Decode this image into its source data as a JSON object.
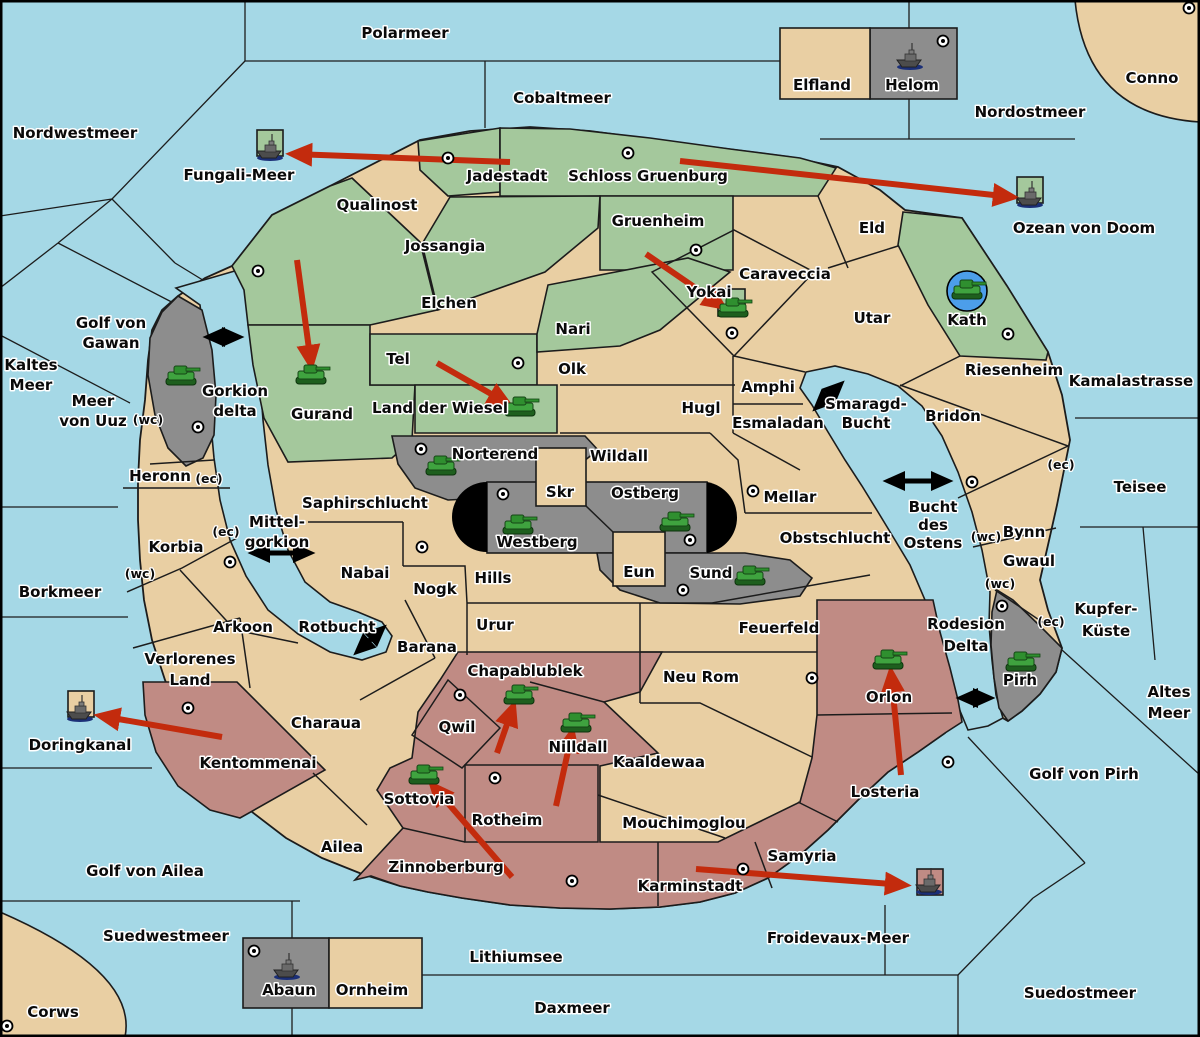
{
  "map": {
    "title": "Fantasy conquest map",
    "colors": {
      "sea": "#A5D8E6",
      "land": "#E9CFA3",
      "green": "#A4C89C",
      "gray": "#8D8D8D",
      "maroon": "#C08B84",
      "black": "#000000",
      "arrow_red": "#C32B0D",
      "kath_circle_blue": "#4C9EEA",
      "border": "#1C1C1C"
    },
    "labels": [
      {
        "t": "Polarmeer",
        "x": 405,
        "y": 38,
        "k": "sea"
      },
      {
        "t": "Cobaltmeer",
        "x": 562,
        "y": 103,
        "k": "sea"
      },
      {
        "t": "Nordostmeer",
        "x": 1030,
        "y": 117,
        "k": "sea"
      },
      {
        "t": "Nordwestmeer",
        "x": 75,
        "y": 138,
        "k": "sea"
      },
      {
        "t": "Conno",
        "x": 1152,
        "y": 83,
        "k": "land"
      },
      {
        "t": "Fungali-Meer",
        "x": 239,
        "y": 180,
        "k": "sea"
      },
      {
        "t": "Ozean von Doom",
        "x": 1084,
        "y": 233,
        "k": "sea"
      },
      {
        "t": "Kaltes",
        "x": 31,
        "y": 370,
        "k": "sea"
      },
      {
        "t": "Meer",
        "x": 31,
        "y": 390,
        "k": "sea"
      },
      {
        "t": "Golf von",
        "x": 111,
        "y": 328,
        "k": "sea"
      },
      {
        "t": "Gawan",
        "x": 111,
        "y": 348,
        "k": "sea"
      },
      {
        "t": "Meer",
        "x": 93,
        "y": 406,
        "k": "sea"
      },
      {
        "t": "von Uuz",
        "x": 93,
        "y": 426,
        "k": "sea"
      },
      {
        "t": "Gorkion",
        "x": 235,
        "y": 396,
        "k": "sea"
      },
      {
        "t": "delta",
        "x": 235,
        "y": 416,
        "k": "sea"
      },
      {
        "t": "Kamalastrasse",
        "x": 1131,
        "y": 386,
        "k": "sea"
      },
      {
        "t": "Teisee",
        "x": 1140,
        "y": 492,
        "k": "sea"
      },
      {
        "t": "Smaragd-",
        "x": 866,
        "y": 409,
        "k": "sea"
      },
      {
        "t": "Bucht",
        "x": 866,
        "y": 428,
        "k": "sea"
      },
      {
        "t": "Bucht",
        "x": 933,
        "y": 512,
        "k": "sea"
      },
      {
        "t": "des",
        "x": 933,
        "y": 530,
        "k": "sea"
      },
      {
        "t": "Ostens",
        "x": 933,
        "y": 548,
        "k": "sea"
      },
      {
        "t": "Mittel-",
        "x": 277,
        "y": 527,
        "k": "sea"
      },
      {
        "t": "gorkion",
        "x": 277,
        "y": 547,
        "k": "sea"
      },
      {
        "t": "Borkmeer",
        "x": 60,
        "y": 597,
        "k": "sea"
      },
      {
        "t": "Rotbucht",
        "x": 337,
        "y": 632,
        "k": "sea"
      },
      {
        "t": "Kupfer-",
        "x": 1106,
        "y": 614,
        "k": "sea"
      },
      {
        "t": "Küste",
        "x": 1106,
        "y": 636,
        "k": "sea"
      },
      {
        "t": "Altes",
        "x": 1169,
        "y": 697,
        "k": "sea"
      },
      {
        "t": "Meer",
        "x": 1169,
        "y": 718,
        "k": "sea"
      },
      {
        "t": "Golf von Pirh",
        "x": 1084,
        "y": 779,
        "k": "sea"
      },
      {
        "t": "Rodesion",
        "x": 966,
        "y": 629,
        "k": "sea"
      },
      {
        "t": "Delta",
        "x": 966,
        "y": 651,
        "k": "sea"
      },
      {
        "t": "Doringkanal",
        "x": 80,
        "y": 750,
        "k": "sea"
      },
      {
        "t": "Golf von Ailea",
        "x": 145,
        "y": 876,
        "k": "sea"
      },
      {
        "t": "Suedwestmeer",
        "x": 166,
        "y": 941,
        "k": "sea"
      },
      {
        "t": "Corws",
        "x": 53,
        "y": 1017,
        "k": "land"
      },
      {
        "t": "Lithiumsee",
        "x": 516,
        "y": 962,
        "k": "sea"
      },
      {
        "t": "Daxmeer",
        "x": 572,
        "y": 1013,
        "k": "sea"
      },
      {
        "t": "Froidevaux-Meer",
        "x": 838,
        "y": 943,
        "k": "sea"
      },
      {
        "t": "Suedostmeer",
        "x": 1080,
        "y": 998,
        "k": "sea"
      },
      {
        "t": "Elfland",
        "x": 822,
        "y": 90,
        "k": "land"
      },
      {
        "t": "Helom",
        "x": 912,
        "y": 90,
        "k": "land"
      },
      {
        "t": "Jadestadt",
        "x": 507,
        "y": 181,
        "k": "land"
      },
      {
        "t": "Schloss Gruenburg",
        "x": 648,
        "y": 181,
        "k": "land"
      },
      {
        "t": "Qualinost",
        "x": 377,
        "y": 210,
        "k": "land"
      },
      {
        "t": "Jossangia",
        "x": 445,
        "y": 251,
        "k": "land"
      },
      {
        "t": "Gruenheim",
        "x": 658,
        "y": 226,
        "k": "land"
      },
      {
        "t": "Caraveccia",
        "x": 785,
        "y": 279,
        "k": "land"
      },
      {
        "t": "Eld",
        "x": 872,
        "y": 233,
        "k": "land"
      },
      {
        "t": "Elchen",
        "x": 449,
        "y": 308,
        "k": "land"
      },
      {
        "t": "Nari",
        "x": 573,
        "y": 334,
        "k": "land"
      },
      {
        "t": "Yokai",
        "x": 709,
        "y": 297,
        "k": "land"
      },
      {
        "t": "Utar",
        "x": 872,
        "y": 323,
        "k": "land"
      },
      {
        "t": "Kath",
        "x": 967,
        "y": 325,
        "k": "land"
      },
      {
        "t": "Tel",
        "x": 398,
        "y": 364,
        "k": "land"
      },
      {
        "t": "Land der Wiesel",
        "x": 440,
        "y": 413,
        "k": "land"
      },
      {
        "t": "Olk",
        "x": 572,
        "y": 374,
        "k": "land"
      },
      {
        "t": "Gurand",
        "x": 322,
        "y": 419,
        "k": "land"
      },
      {
        "t": "Hugl",
        "x": 701,
        "y": 413,
        "k": "land"
      },
      {
        "t": "Amphi",
        "x": 768,
        "y": 392,
        "k": "land"
      },
      {
        "t": "Esmaladan",
        "x": 778,
        "y": 428,
        "k": "land"
      },
      {
        "t": "Riesenheim",
        "x": 1014,
        "y": 375,
        "k": "land"
      },
      {
        "t": "Bridon",
        "x": 953,
        "y": 421,
        "k": "land"
      },
      {
        "t": "Norterend",
        "x": 495,
        "y": 459,
        "k": "land"
      },
      {
        "t": "Wildall",
        "x": 619,
        "y": 461,
        "k": "land"
      },
      {
        "t": "Skr",
        "x": 560,
        "y": 497,
        "k": "land"
      },
      {
        "t": "Ostberg",
        "x": 645,
        "y": 498,
        "k": "land"
      },
      {
        "t": "Mellar",
        "x": 790,
        "y": 502,
        "k": "land"
      },
      {
        "t": "Westberg",
        "x": 537,
        "y": 547,
        "k": "land"
      },
      {
        "t": "Obstschlucht",
        "x": 835,
        "y": 543,
        "k": "land"
      },
      {
        "t": "Saphirschlucht",
        "x": 365,
        "y": 508,
        "k": "land"
      },
      {
        "t": "Heronn",
        "x": 160,
        "y": 481,
        "k": "land"
      },
      {
        "t": "Korbia",
        "x": 176,
        "y": 552,
        "k": "land"
      },
      {
        "t": "Nabai",
        "x": 365,
        "y": 578,
        "k": "land"
      },
      {
        "t": "Eun",
        "x": 639,
        "y": 577,
        "k": "land"
      },
      {
        "t": "Sund",
        "x": 711,
        "y": 578,
        "k": "land"
      },
      {
        "t": "Hills",
        "x": 493,
        "y": 583,
        "k": "land"
      },
      {
        "t": "Nogk",
        "x": 435,
        "y": 594,
        "k": "land"
      },
      {
        "t": "Urur",
        "x": 495,
        "y": 630,
        "k": "land"
      },
      {
        "t": "Feuerfeld",
        "x": 779,
        "y": 633,
        "k": "land"
      },
      {
        "t": "Barana",
        "x": 427,
        "y": 652,
        "k": "land"
      },
      {
        "t": "Neu Rom",
        "x": 701,
        "y": 682,
        "k": "land"
      },
      {
        "t": "Arkoon",
        "x": 243,
        "y": 632,
        "k": "land"
      },
      {
        "t": "Chapablublek",
        "x": 525,
        "y": 676,
        "k": "land"
      },
      {
        "t": "Kaaldewaa",
        "x": 659,
        "y": 767,
        "k": "land"
      },
      {
        "t": "Qwil",
        "x": 457,
        "y": 732,
        "k": "land"
      },
      {
        "t": "Nilldall",
        "x": 578,
        "y": 752,
        "k": "land"
      },
      {
        "t": "Mouchimoglou",
        "x": 684,
        "y": 828,
        "k": "land"
      },
      {
        "t": "Sottovia",
        "x": 419,
        "y": 804,
        "k": "land"
      },
      {
        "t": "Rotheim",
        "x": 507,
        "y": 825,
        "k": "land"
      },
      {
        "t": "Kentommenai",
        "x": 258,
        "y": 768,
        "k": "land"
      },
      {
        "t": "Charaua",
        "x": 326,
        "y": 728,
        "k": "land"
      },
      {
        "t": "Ailea",
        "x": 342,
        "y": 852,
        "k": "land"
      },
      {
        "t": "Zinnoberburg",
        "x": 446,
        "y": 872,
        "k": "land"
      },
      {
        "t": "Karminstadt",
        "x": 690,
        "y": 891,
        "k": "land"
      },
      {
        "t": "Samyria",
        "x": 802,
        "y": 861,
        "k": "land"
      },
      {
        "t": "Losteria",
        "x": 885,
        "y": 797,
        "k": "land"
      },
      {
        "t": "Orlon",
        "x": 889,
        "y": 702,
        "k": "land"
      },
      {
        "t": "Pirh",
        "x": 1020,
        "y": 685,
        "k": "land"
      },
      {
        "t": "Bynn",
        "x": 1024,
        "y": 537,
        "k": "land"
      },
      {
        "t": "Gwaul",
        "x": 1029,
        "y": 566,
        "k": "land"
      },
      {
        "t": "Verlorenes",
        "x": 190,
        "y": 664,
        "k": "land"
      },
      {
        "t": "Land",
        "x": 190,
        "y": 685,
        "k": "land"
      },
      {
        "t": "Abaun",
        "x": 289,
        "y": 995,
        "k": "land"
      },
      {
        "t": "Ornheim",
        "x": 372,
        "y": 995,
        "k": "land"
      },
      {
        "t": "(wc)",
        "x": 148,
        "y": 424,
        "k": "small"
      },
      {
        "t": "(wc)",
        "x": 140,
        "y": 578,
        "k": "small"
      },
      {
        "t": "(wc)",
        "x": 986,
        "y": 541,
        "k": "small"
      },
      {
        "t": "(wc)",
        "x": 1000,
        "y": 588,
        "k": "small"
      },
      {
        "t": "(ec)",
        "x": 209,
        "y": 483,
        "k": "small"
      },
      {
        "t": "(ec)",
        "x": 226,
        "y": 536,
        "k": "small"
      },
      {
        "t": "(ec)",
        "x": 1061,
        "y": 469,
        "k": "small"
      },
      {
        "t": "(ec)",
        "x": 1051,
        "y": 626,
        "k": "small"
      }
    ],
    "markers": [
      [
        448,
        158
      ],
      [
        628,
        153
      ],
      [
        943,
        41
      ],
      [
        1189,
        8
      ],
      [
        258,
        271
      ],
      [
        696,
        250
      ],
      [
        732,
        333
      ],
      [
        1008,
        334
      ],
      [
        518,
        363
      ],
      [
        198,
        427
      ],
      [
        230,
        562
      ],
      [
        421,
        449
      ],
      [
        503,
        494
      ],
      [
        690,
        540
      ],
      [
        683,
        590
      ],
      [
        753,
        491
      ],
      [
        422,
        547
      ],
      [
        460,
        695
      ],
      [
        495,
        778
      ],
      [
        572,
        881
      ],
      [
        743,
        869
      ],
      [
        188,
        708
      ],
      [
        948,
        762
      ],
      [
        812,
        678
      ],
      [
        972,
        482
      ],
      [
        1002,
        606
      ],
      [
        254,
        951
      ],
      [
        7,
        1026
      ]
    ],
    "units": [
      {
        "k": "tank",
        "x": 181,
        "y": 377
      },
      {
        "k": "tank",
        "x": 311,
        "y": 376
      },
      {
        "k": "tank",
        "x": 520,
        "y": 408
      },
      {
        "k": "tank",
        "x": 733,
        "y": 309
      },
      {
        "k": "tank",
        "x": 967,
        "y": 291,
        "circled": true
      },
      {
        "k": "tank",
        "x": 441,
        "y": 467
      },
      {
        "k": "tank",
        "x": 518,
        "y": 526
      },
      {
        "k": "tank",
        "x": 675,
        "y": 523
      },
      {
        "k": "tank",
        "x": 750,
        "y": 577
      },
      {
        "k": "tank",
        "x": 519,
        "y": 696
      },
      {
        "k": "tank",
        "x": 576,
        "y": 724
      },
      {
        "k": "tank",
        "x": 424,
        "y": 776
      },
      {
        "k": "tank",
        "x": 888,
        "y": 661
      },
      {
        "k": "tank",
        "x": 1021,
        "y": 663
      },
      {
        "k": "ship",
        "x": 270,
        "y": 150
      },
      {
        "k": "ship",
        "x": 910,
        "y": 59
      },
      {
        "k": "ship",
        "x": 1030,
        "y": 197
      },
      {
        "k": "ship",
        "x": 80,
        "y": 711
      },
      {
        "k": "ship",
        "x": 929,
        "y": 884
      },
      {
        "k": "ship",
        "x": 287,
        "y": 969
      }
    ],
    "unit_boxes": [
      {
        "x": 257,
        "y": 130,
        "w": 26,
        "h": 26,
        "c": "green"
      },
      {
        "x": 1017,
        "y": 177,
        "w": 26,
        "h": 26,
        "c": "green"
      },
      {
        "x": 718,
        "y": 289,
        "w": 27,
        "h": 27,
        "c": "green"
      },
      {
        "x": 68,
        "y": 691,
        "w": 26,
        "h": 26,
        "c": "land"
      },
      {
        "x": 917,
        "y": 869,
        "w": 26,
        "h": 26,
        "c": "maroon"
      }
    ],
    "red_arrows": [
      [
        510,
        162,
        293,
        154
      ],
      [
        680,
        161,
        1012,
        197
      ],
      [
        297,
        260,
        311,
        364
      ],
      [
        437,
        363,
        507,
        403
      ],
      [
        646,
        254,
        722,
        306
      ],
      [
        497,
        753,
        513,
        707
      ],
      [
        556,
        806,
        572,
        733
      ],
      [
        512,
        877,
        433,
        786
      ],
      [
        901,
        775,
        891,
        673
      ],
      [
        696,
        869,
        904,
        885
      ],
      [
        222,
        737,
        101,
        716
      ]
    ],
    "black_arrows": [
      [
        209,
        337,
        238,
        337
      ],
      [
        254,
        553,
        309,
        553
      ],
      [
        358,
        651,
        382,
        629
      ],
      [
        817,
        407,
        840,
        385
      ],
      [
        889,
        481,
        947,
        481
      ],
      [
        962,
        698,
        989,
        698
      ]
    ]
  }
}
